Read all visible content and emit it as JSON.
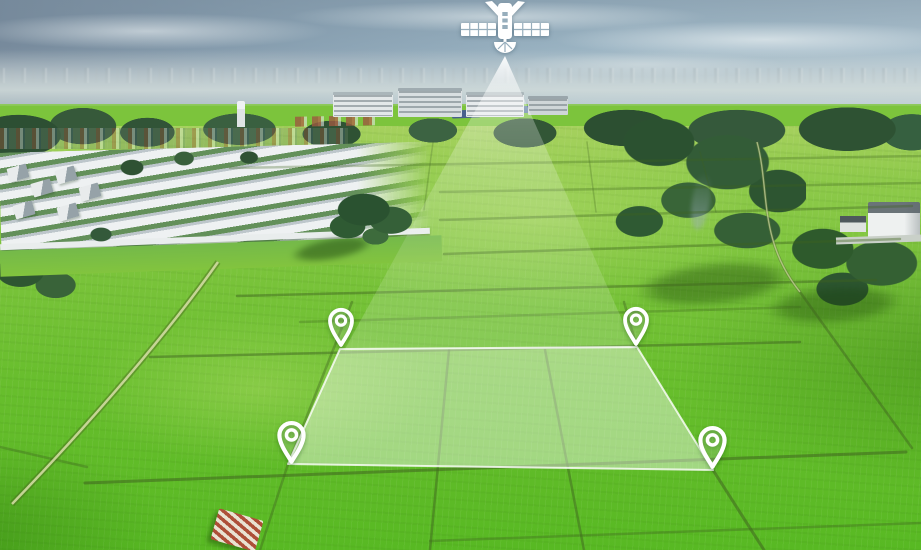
{
  "scene": {
    "description": "Aerial drone photograph of bright green farmland plots beside a suburban housing estate; a white satellite icon in the sky projects a light beam onto a translucent highlighted land parcel marked at its four corners by white location pins (land-surveying / GPS land-plot concept illustration)",
    "environment": {
      "sky": "hazy blue-grey sky with wispy clouds",
      "horizon": "distant low-rise town in haze",
      "left": "white-roofed housing development rows with trees",
      "center": "mid-rise apartment blocks behind tree line",
      "right": "dense trees, white villa, field shadows and smoke plume",
      "foreground": "vivid green paddock grid with dark boundary paths and a small red-striped roof hut"
    },
    "palette": {
      "sky_top": "#76899b",
      "sky_light": "#a9bfcc",
      "haze": "#d0dadb",
      "tree_dark": "#2d5131",
      "field_far": "#a6d15e",
      "field_mid": "#7cc43c",
      "field_near": "#58b923",
      "boundary_line": "#3f6420",
      "overlay_white": "#ffffff"
    }
  },
  "overlay": {
    "satellite_icon": {
      "x": 460,
      "y": 0,
      "width": 90,
      "height": 60
    },
    "beam": {
      "apex_x": 505,
      "apex_y": 56,
      "left_x": 345,
      "right_x": 635,
      "base_y": 349
    },
    "parcel": {
      "corners": [
        [
          340,
          349
        ],
        [
          637,
          347
        ],
        [
          713,
          470
        ],
        [
          288,
          464
        ]
      ]
    },
    "pins": [
      {
        "id": "map-pin-top-left",
        "tip_x": 341,
        "tip_y": 347,
        "w": 30,
        "h": 40
      },
      {
        "id": "map-pin-top-right",
        "tip_x": 636,
        "tip_y": 346,
        "w": 30,
        "h": 40
      },
      {
        "id": "map-pin-bottom-left",
        "tip_x": 291,
        "tip_y": 464,
        "w": 33,
        "h": 44
      },
      {
        "id": "map-pin-bottom-right",
        "tip_x": 712,
        "tip_y": 469,
        "w": 33,
        "h": 44
      }
    ]
  }
}
